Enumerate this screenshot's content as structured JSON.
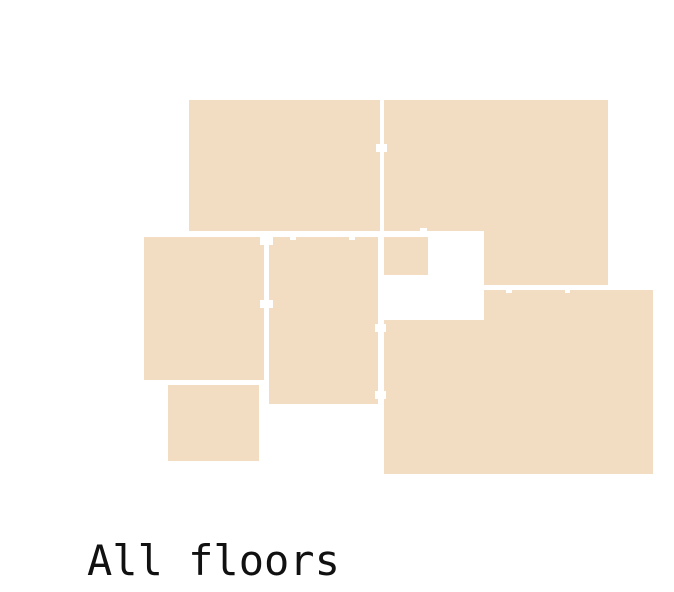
{
  "caption": {
    "text": "All floors",
    "x": 87,
    "y": 540,
    "font_size": 42,
    "color": "#111111"
  },
  "colors": {
    "room_fill": "#f2dcc2",
    "wall_gap": "#ffffff",
    "background": "#ffffff"
  },
  "floorplan": {
    "rooms": [
      {
        "name": "room-top-left",
        "x": 189,
        "y": 100,
        "w": 191,
        "h": 131
      },
      {
        "name": "room-top-right-main",
        "x": 384,
        "y": 100,
        "w": 224,
        "h": 131
      },
      {
        "name": "room-top-right-extension",
        "x": 484,
        "y": 231,
        "w": 124,
        "h": 54
      },
      {
        "name": "room-closet",
        "x": 384,
        "y": 237,
        "w": 44,
        "h": 38
      },
      {
        "name": "room-left-middle",
        "x": 144,
        "y": 237,
        "w": 120,
        "h": 143
      },
      {
        "name": "room-center",
        "x": 269,
        "y": 237,
        "w": 109,
        "h": 167
      },
      {
        "name": "room-small-bottom",
        "x": 168,
        "y": 385,
        "w": 91,
        "h": 76
      },
      {
        "name": "room-bottom-right-upper",
        "x": 484,
        "y": 290,
        "w": 169,
        "h": 184
      },
      {
        "name": "room-bottom-right-left",
        "x": 384,
        "y": 320,
        "w": 100,
        "h": 154
      }
    ],
    "doors": [
      {
        "name": "door-topleft-topright",
        "x": 376,
        "y": 144,
        "w": 11,
        "h": 8
      },
      {
        "name": "door-topleft-center-1",
        "x": 290,
        "y": 231,
        "w": 6,
        "h": 9
      },
      {
        "name": "door-topleft-center-2",
        "x": 349,
        "y": 231,
        "w": 6,
        "h": 9
      },
      {
        "name": "door-topright-closet",
        "x": 420,
        "y": 228,
        "w": 7,
        "h": 9
      },
      {
        "name": "door-leftmiddle-center-top",
        "x": 260,
        "y": 237,
        "w": 13,
        "h": 8
      },
      {
        "name": "door-leftmiddle-center-bottom",
        "x": 260,
        "y": 300,
        "w": 13,
        "h": 8
      },
      {
        "name": "door-center-bottomright-top",
        "x": 375,
        "y": 324,
        "w": 11,
        "h": 8
      },
      {
        "name": "door-center-bottomright-bottom",
        "x": 375,
        "y": 391,
        "w": 11,
        "h": 8
      },
      {
        "name": "door-topright-bottomright-1",
        "x": 506,
        "y": 285,
        "w": 6,
        "h": 8
      },
      {
        "name": "door-topright-bottomright-2",
        "x": 565,
        "y": 285,
        "w": 5,
        "h": 8
      }
    ]
  }
}
